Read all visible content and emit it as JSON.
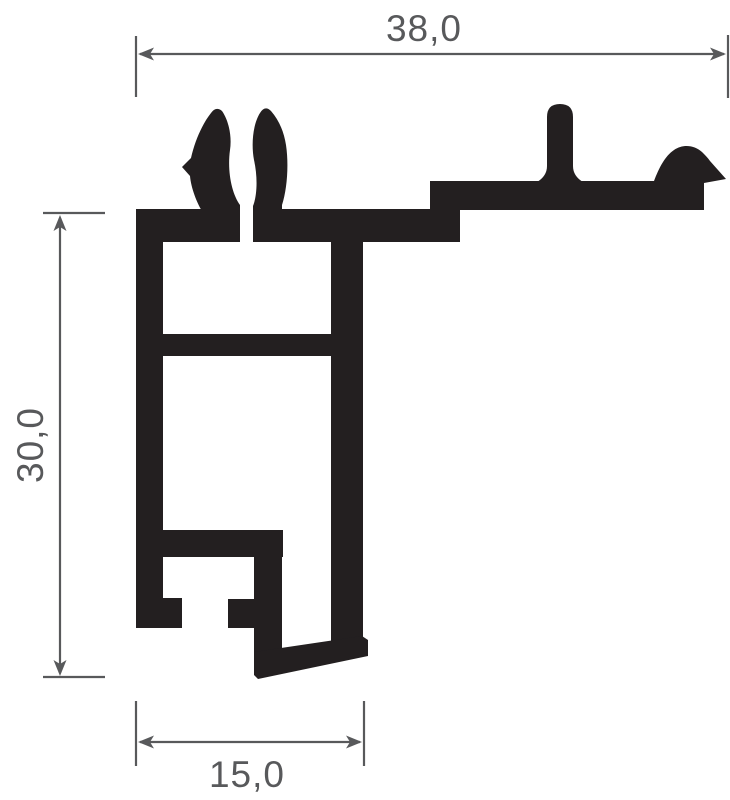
{
  "drawing": {
    "dimensions": {
      "top_width_label": "38,0",
      "left_height_label": "30,0",
      "bottom_width_label": "15,0"
    },
    "colors": {
      "profile": "#231f20",
      "dimension": "#58595b",
      "background": "#ffffff"
    }
  }
}
